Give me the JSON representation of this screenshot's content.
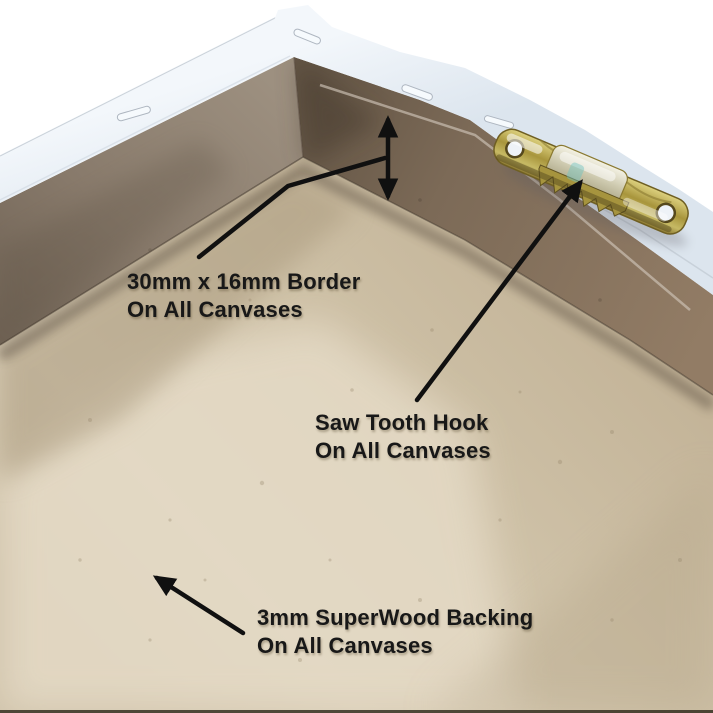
{
  "annotations": {
    "border": {
      "label_line1": "30mm x 16mm Border",
      "label_line2": "On All Canvases"
    },
    "hook": {
      "label_line1": "Saw Tooth Hook",
      "label_line2": "On All Canvases"
    },
    "backing": {
      "label_line1": "3mm SuperWood Backing",
      "label_line2": "On All Canvases"
    }
  },
  "colors": {
    "background": "#ffffff",
    "annotation_ink": "#101010",
    "canvas_edge_white": "#e9eff6",
    "frame_wood_brown": "#84715e",
    "backing_tan": "#d2c5ac",
    "hook_brass": "#b3a04a"
  }
}
